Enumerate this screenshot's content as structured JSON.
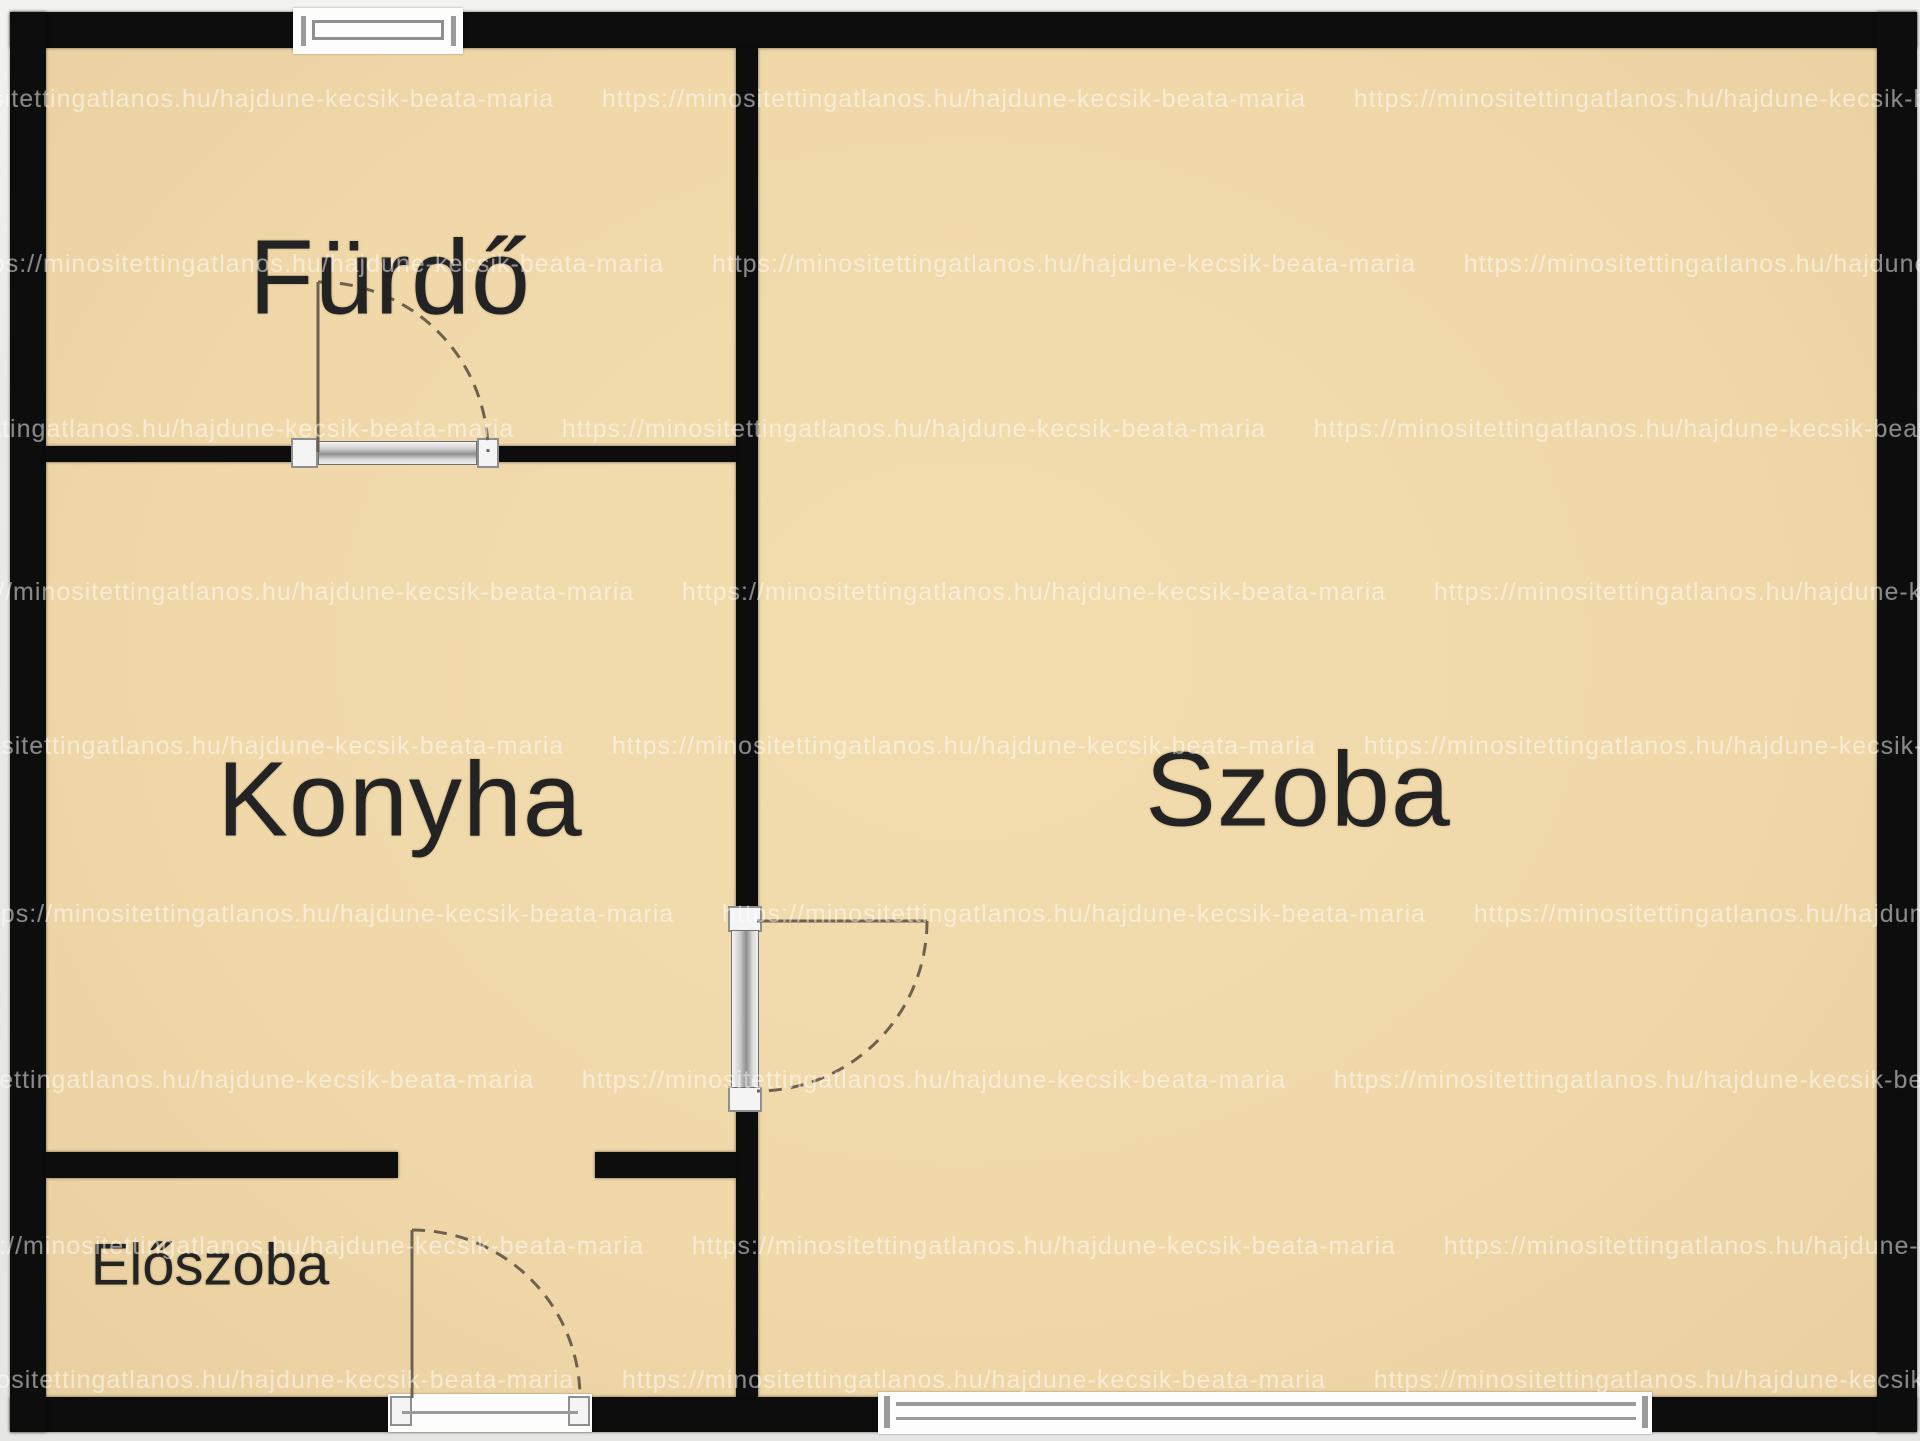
{
  "plan": {
    "rooms": {
      "bathroom": {
        "label": "Fürdő"
      },
      "kitchen": {
        "label": "Konyha"
      },
      "living": {
        "label": "Szoba"
      },
      "hall": {
        "label": "Előszoba"
      }
    },
    "watermark": {
      "text": "https://minositettingatlanos.hu/hajdune-kecsik-beata-maria      https://minositettingatlanos.hu/hajdune-kecsik-beata-maria      https://minositettingatlanos.hu/hajdune-kecsik-beata-maria      https://minositettingatlanos.hu/hajdune-kecsik-beata-maria"
    },
    "colors": {
      "floor": "#f0d8a9",
      "wall": "#0d0d0d",
      "outside": "#e9e9e9",
      "label_text": "#232323",
      "door_swing_line": "#6e6150",
      "fixture_frame": "#fdfdfd",
      "fixture_detail": "#9b9b9b",
      "watermark": "rgba(255,255,255,0.44)"
    }
  }
}
